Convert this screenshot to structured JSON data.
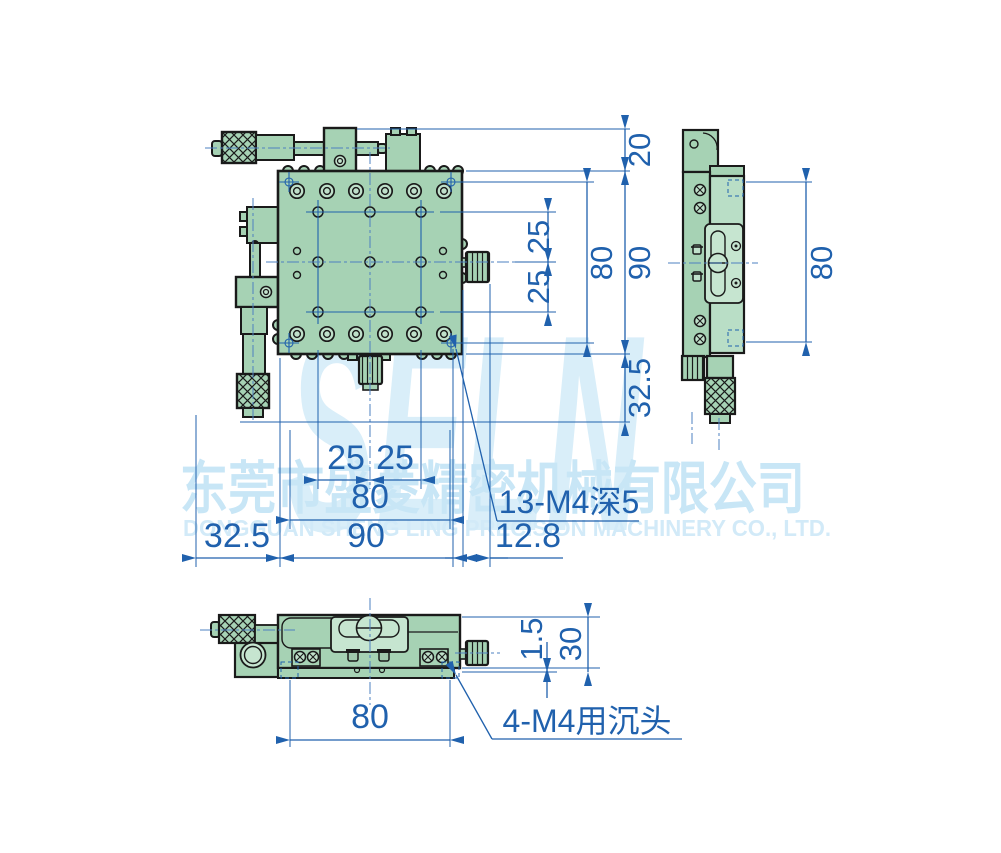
{
  "colors": {
    "body_green": "#a6d2b4",
    "plate_green": "#c6e5d0",
    "outline": "#1a1a1a",
    "dimension_blue": "#2061ad",
    "centerline_blue": "#4d80c0",
    "watermark_blue": "#d9eef9"
  },
  "watermark": {
    "logo": "SELN",
    "company_cn": "东莞市盛菱精密机械有限公司",
    "company_en": "DONGGUAN SHENG LING PRECISION MACHINERY CO., LTD."
  },
  "dims": {
    "front": {
      "top_block": "20",
      "height": "90",
      "hole_span_v": "80",
      "pitch_v1": "25",
      "pitch_v2": "25",
      "bottom_offset": "32.5",
      "pitch_h1": "25",
      "pitch_h2": "25",
      "hole_span_h": "80",
      "left_offset": "32.5",
      "width": "90",
      "knob_offset": "12.8",
      "holes_label": "13-M4深5"
    },
    "side": {
      "hole_span": "80"
    },
    "bottom": {
      "step": "1.5",
      "height": "30",
      "hole_span": "80",
      "holes_label": "4-M4用沉头"
    }
  }
}
